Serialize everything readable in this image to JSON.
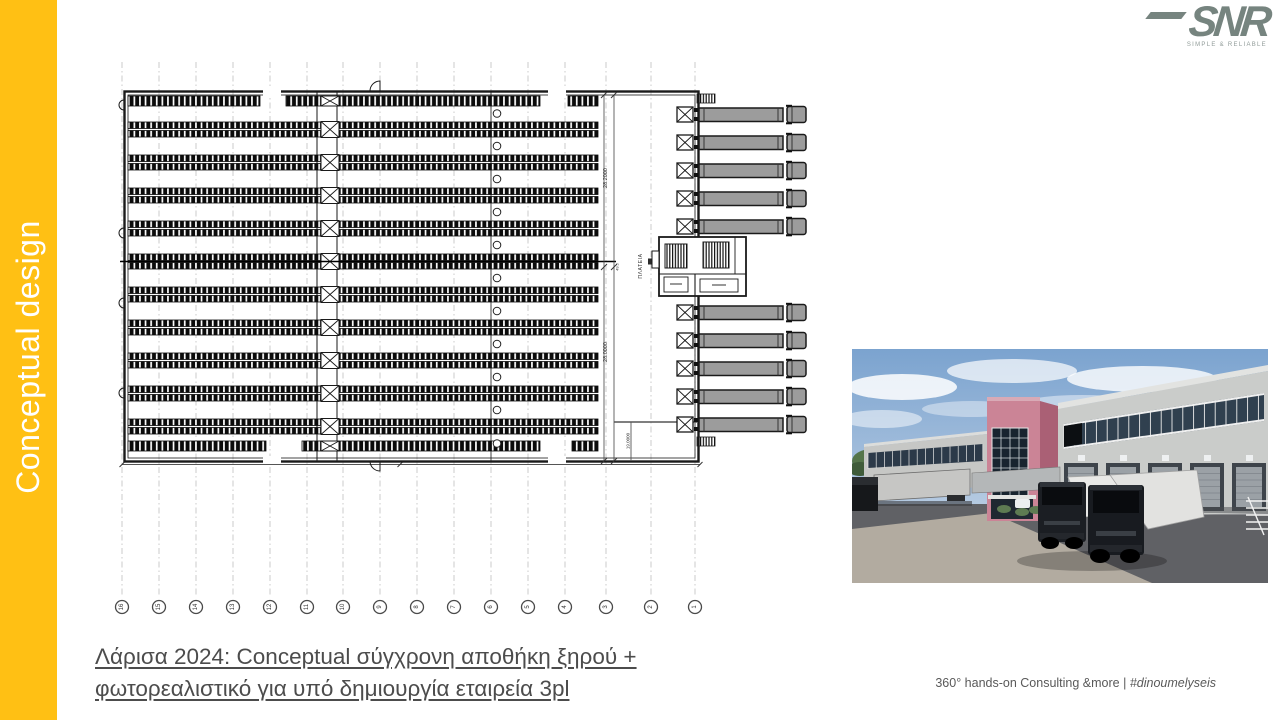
{
  "sidebar": {
    "label": "Conceptual design",
    "bg_color": "#FFC014",
    "text_color": "#FFFFFF"
  },
  "logo": {
    "text": "SNR",
    "tagline": "SIMPLE & RELIABLE",
    "color": "#76847F"
  },
  "title": {
    "line1": "Λάρισα 2024: Conceptual σύγχρονη αποθήκη ξηρού +",
    "line2": "φωτορεαλιστικό για υπό δημιουργία εταιρεία 3pl",
    "color": "#4C4C4C"
  },
  "footer": {
    "prefix": "360° hands-on Consulting &more | ",
    "hashtag": "#dinoumelyseis"
  },
  "floorplan": {
    "grid_bubbles": [
      "16",
      "15",
      "14",
      "13",
      "12",
      "11",
      "10",
      "9",
      "8",
      "7",
      "6",
      "5",
      "4",
      "3",
      "2",
      "1"
    ],
    "grid_x": [
      122,
      159,
      196,
      233,
      270,
      307,
      343,
      380,
      417,
      454,
      491,
      528,
      565,
      606,
      651,
      695
    ],
    "dim_labels": {
      "upper": "28.2000",
      "lower": "28.0000",
      "dock": "19.0000",
      "mid": "49.5",
      "area": "ΠΛΑΤΕΙΑ"
    },
    "rack_row_centers": [
      129.5,
      162.5,
      195.5,
      228.5,
      261.5,
      294.5,
      327.5,
      360.5,
      393.5,
      426.5
    ],
    "truck_y_top": [
      107,
      135,
      163,
      191,
      219
    ],
    "truck_y_bottom": [
      305,
      333,
      361,
      389,
      417
    ],
    "ink_color": "#1A1A1A",
    "truck_fill": "#9C9C9C"
  },
  "photo": {
    "sky_color": "#7BA3CF",
    "building_color": "#CACCCA",
    "tower_pink": "#CB8496",
    "glass_color": "#18242F",
    "asphalt_color": "#606165",
    "concrete_color": "#B2ABA0"
  }
}
